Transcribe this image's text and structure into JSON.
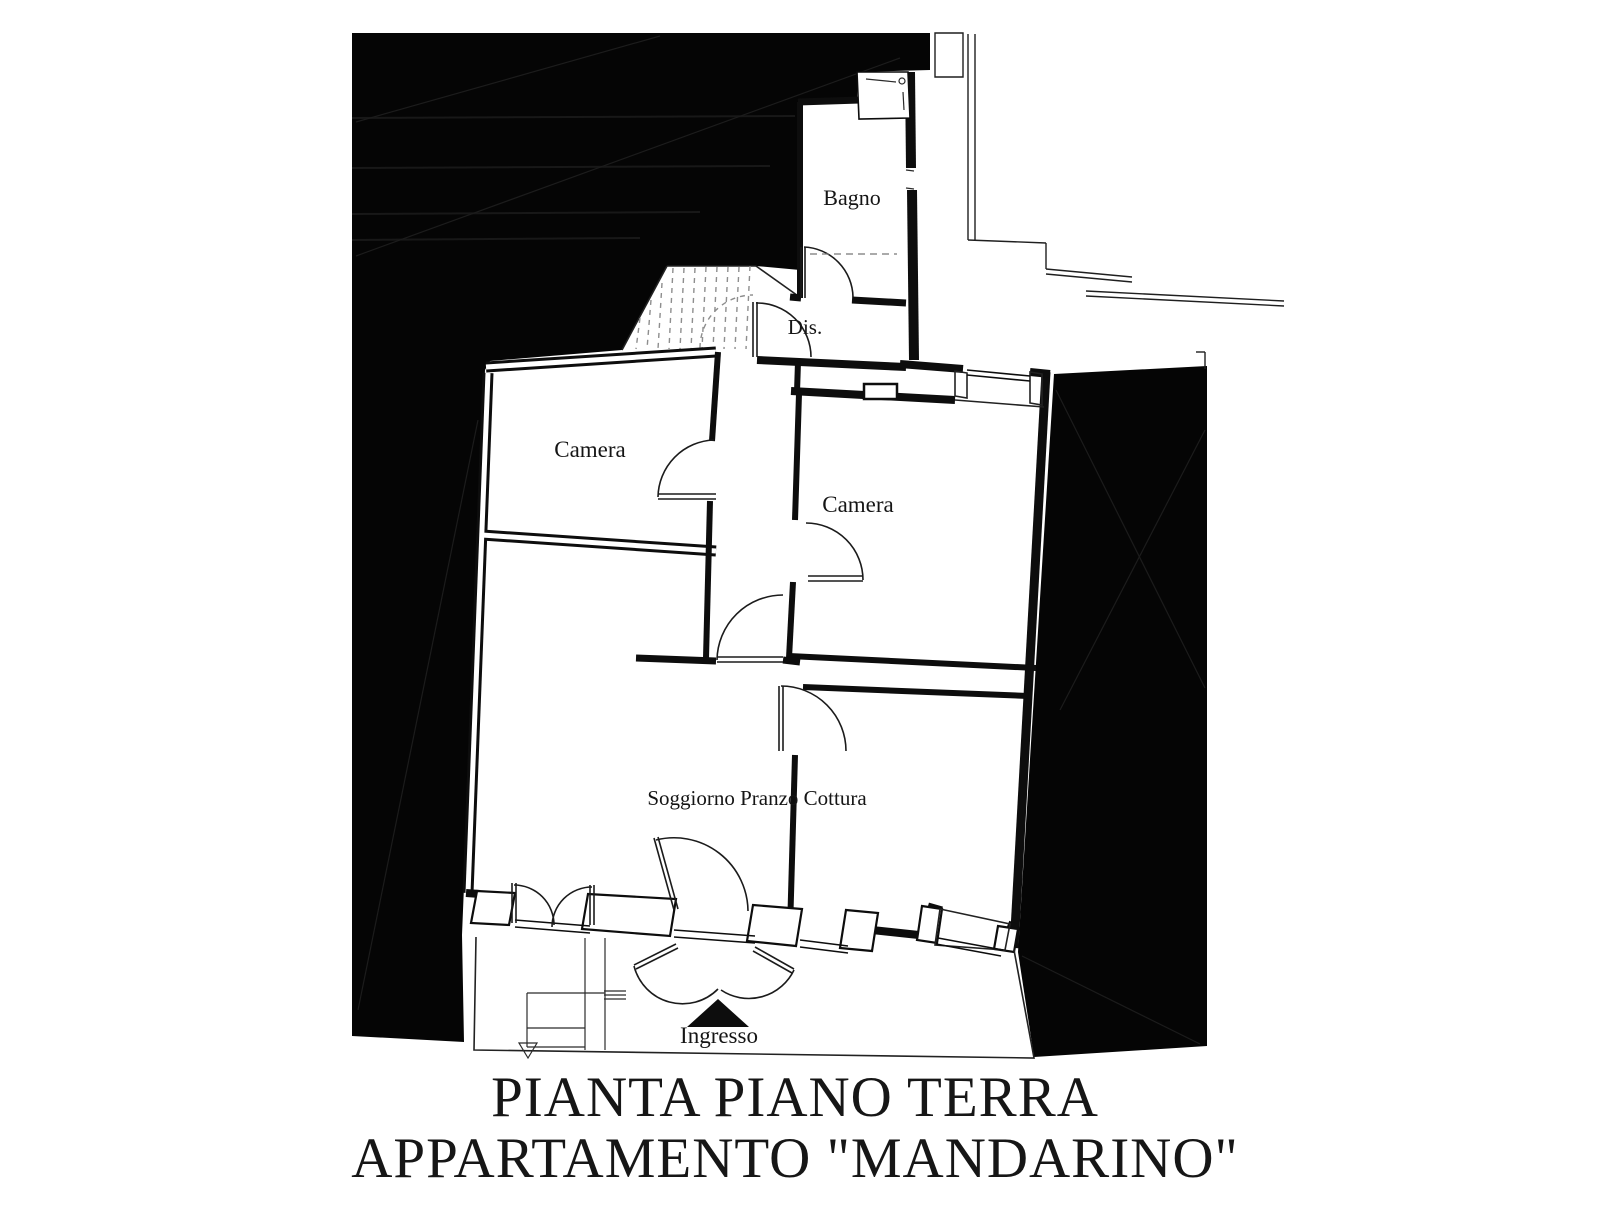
{
  "title": {
    "line1": "PIANTA PIANO TERRA",
    "line2": "APPARTAMENTO \"MANDARINO\""
  },
  "rooms": {
    "bagno": "Bagno",
    "dis": "Dis.",
    "camera_left": "Camera",
    "camera_right": "Camera",
    "soggiorno": "Soggiorno Pranzo Cottura",
    "ingresso": "Ingresso"
  },
  "colors": {
    "ink": "#0d0d0d",
    "paper": "#ffffff",
    "mass": "#050505",
    "tread": "#8e8e8e",
    "dashline": "#777777",
    "label": "#151515"
  }
}
